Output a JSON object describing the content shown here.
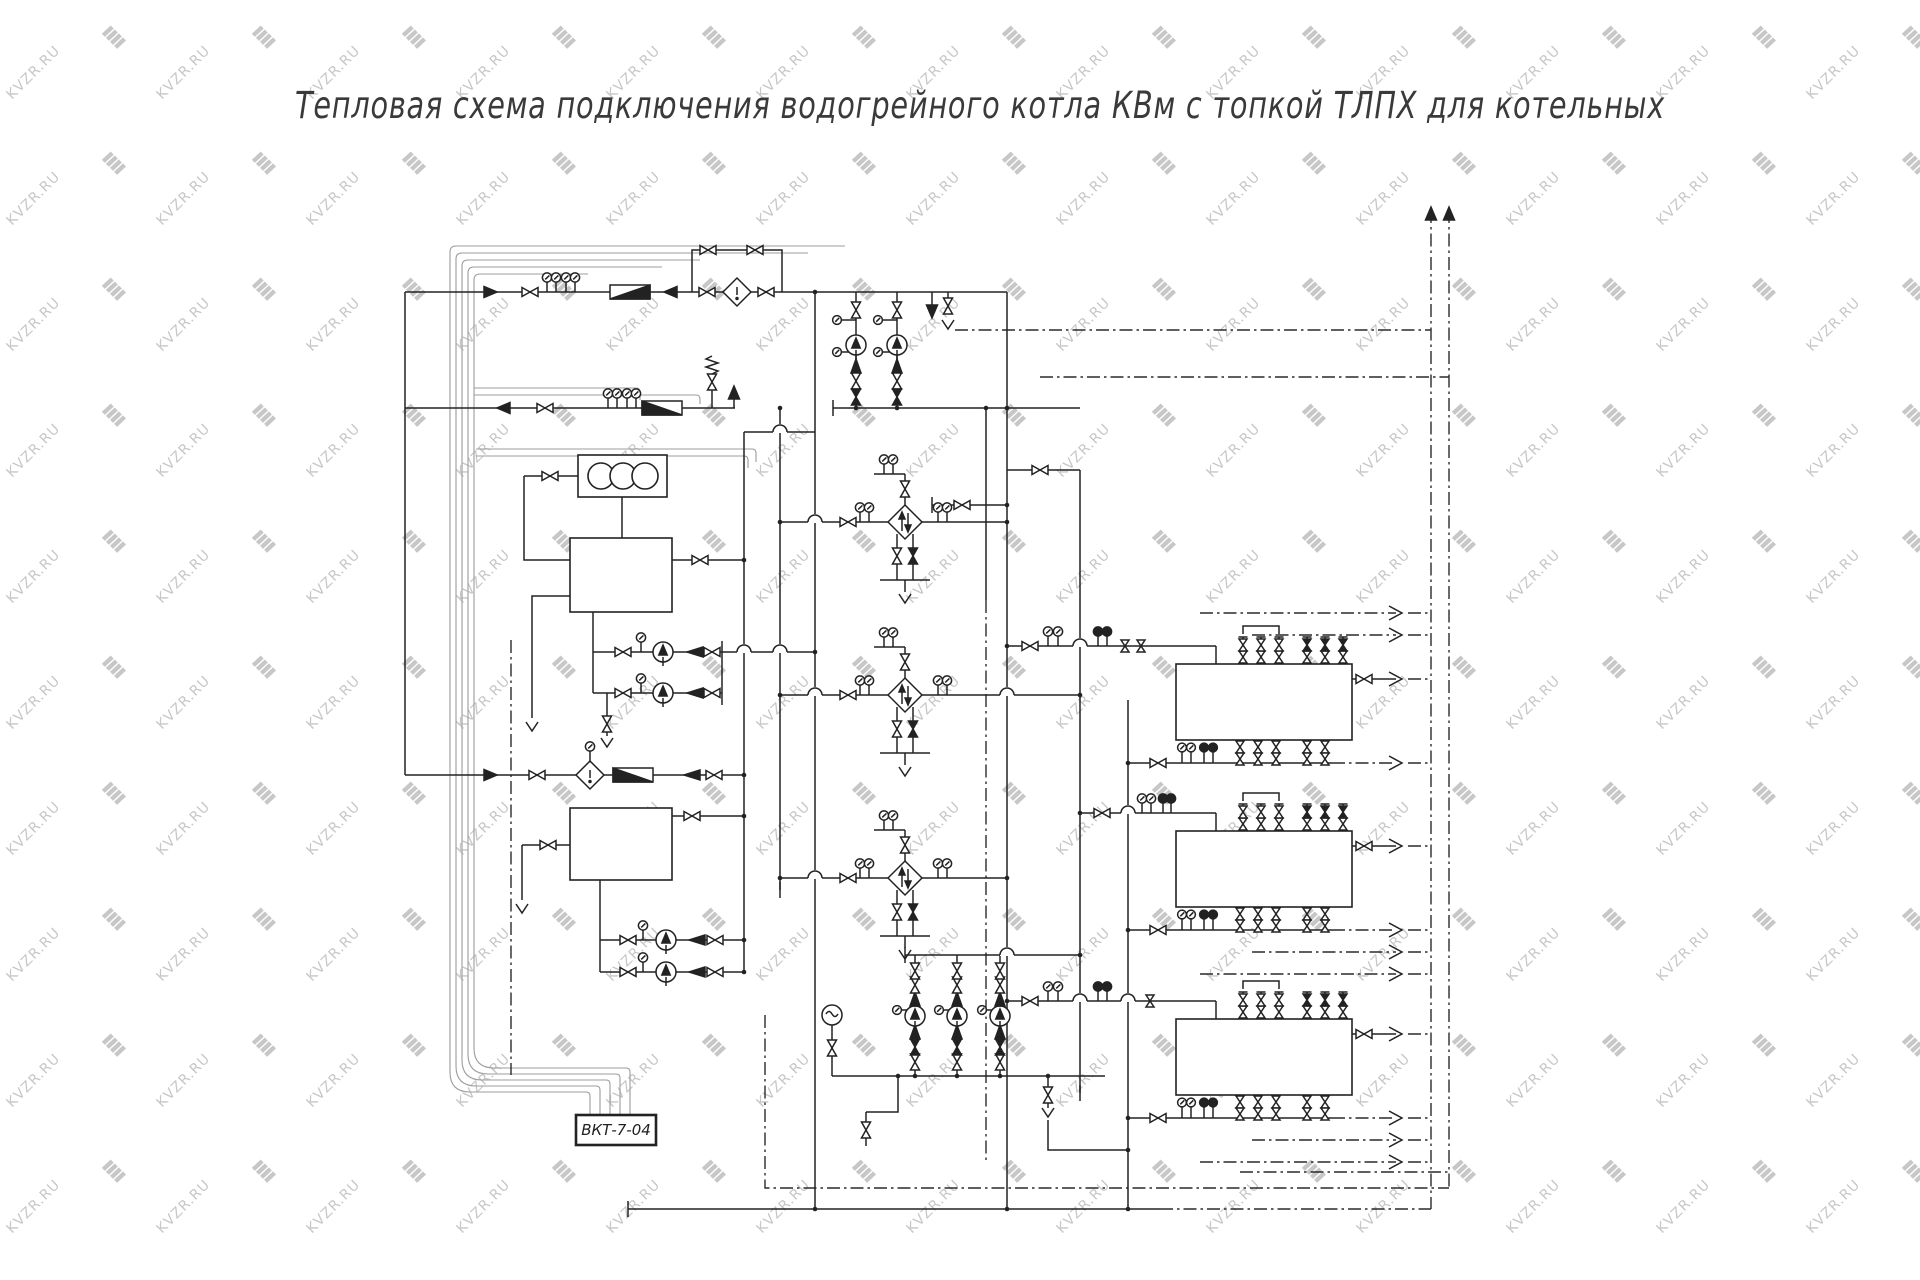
{
  "title": {
    "text": "Тепловая схема подключения водогрейного котла КВм с топкой ТЛПХ  для котельных"
  },
  "watermark": {
    "text": "KVZR.RU",
    "color": "#c7c7c7"
  },
  "controller": {
    "label": "ВКТ-7-04"
  },
  "colors": {
    "line": "#222222",
    "cable": "#9c9c9c",
    "background": "#ffffff"
  }
}
